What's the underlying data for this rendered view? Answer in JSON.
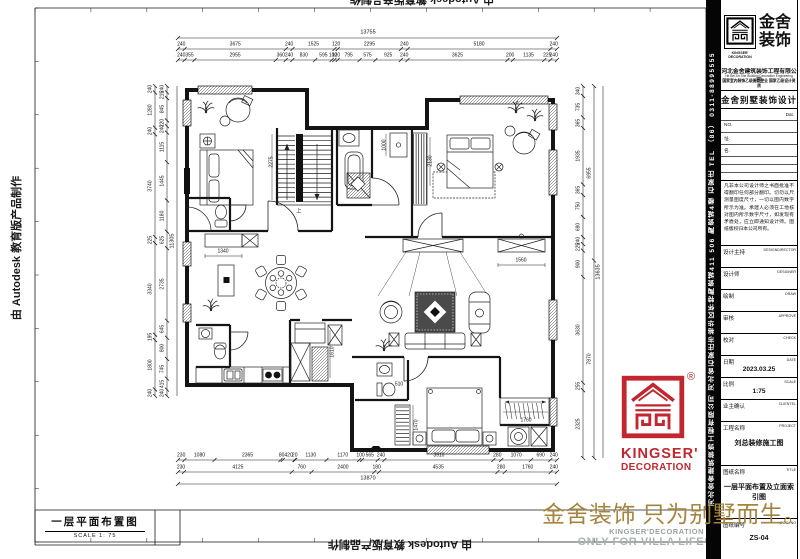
{
  "watermark": {
    "autodesk": "由 Autodesk 教育版产品制作"
  },
  "footer": {
    "slogan": "金舍装饰 只为别墅而生。",
    "brand_en": "KINGSER'DECORATION",
    "tagline": "ONLY FOR VILLA LIFE"
  },
  "drawing_label": {
    "title": "一层平面布置图",
    "scale": "SCALE 1: 75"
  },
  "stamp": {
    "line1": "KINGSER'",
    "line2": "DECORATION",
    "reg": "®"
  },
  "title_block": {
    "brand_cn_1": "金舍",
    "brand_cn_2": "装饰",
    "brand_en": "KINGSER'",
    "brand_en_sub": "DECORATION",
    "company": "河北金舍建筑装饰工程有限公司",
    "company_en": "He Bei Jin She Building Decoration Engineering Co.,Ltd",
    "qualification": "国家室内装饰乙级施工企业 国家乙级设计资质",
    "dept": "金舍别墅装饰设计",
    "date_hint": "Dat.",
    "no_label": "NO.",
    "addr_label": "址.",
    "name_label": "名.",
    "notice": "凡非本公司设计师之书面批准不得翻印任何部分翻印。切勿以尺测量图度尺寸，一切以图内数字所示为准。承建人必须在工地核对图内所示数字尺寸，如发现有矛盾处，应立即通知设计师。图纸版权归本公司所有。",
    "sidebar_text": "河北金舍建筑装饰工程有限公司  河北省石家庄市裕华区怀特陶瓷城411 506 陶瓷城4楼  石家庄  TEL （86） 0311-88995555",
    "fields": [
      {
        "label": "设计主持",
        "en": "DESIGNDIRECTOR",
        "value": ""
      },
      {
        "label": "设计师",
        "en": "DESIGNER",
        "value": ""
      },
      {
        "label": "绘制",
        "en": "DRAW",
        "value": ""
      },
      {
        "label": "审核",
        "en": "APPROVE",
        "value": ""
      },
      {
        "label": "校对",
        "en": "CHECK",
        "value": ""
      },
      {
        "label": "日期",
        "en": "DATE",
        "value": "2023.03.25"
      },
      {
        "label": "比例",
        "en": "SCALE",
        "value": "1:75"
      },
      {
        "label": "业主确认",
        "en": "CLIENTEL",
        "value": ""
      },
      {
        "label": "工程名称",
        "en": "PROJECT",
        "value": "刘总装修施工图"
      },
      {
        "label": "图纸名称",
        "en": "TITLE",
        "value": "一层平面布置及立面索引图"
      },
      {
        "label": "图纸编号",
        "en": "DWG. NO",
        "value": "ZS-04"
      }
    ]
  },
  "plan": {
    "top_total": "13755",
    "top_rows": [
      [
        "240",
        "3675",
        "240",
        "1525",
        "120",
        "2295",
        "240",
        "5180",
        "240"
      ],
      [
        "240",
        "355",
        "2955",
        "360",
        "240",
        "830",
        "595",
        "100",
        "120",
        "795",
        "575",
        "925",
        "240",
        "3625",
        "200",
        "1135",
        "225",
        "240"
      ]
    ],
    "bottom_rows": [
      [
        "230",
        "1080",
        "2365",
        "80",
        "420",
        "20",
        "1130",
        "1170",
        "100",
        "565",
        "240",
        "3910",
        "280",
        "1070",
        "690",
        "240"
      ],
      [
        "230",
        "4125",
        "760",
        "2400",
        "180",
        "4535",
        "280",
        "1760",
        "240"
      ]
    ],
    "bottom_total": "13870",
    "left_total": "11305",
    "left_cols": [
      [
        "240",
        "1280",
        "240",
        "3740",
        "225",
        "3340",
        "195",
        "1800",
        "240"
      ],
      [
        "240",
        "215",
        "845",
        "220",
        "240",
        "1115",
        "1445",
        "1180",
        "625",
        "2735",
        "645",
        "800",
        "745",
        "415",
        "240"
      ]
    ],
    "right_total": "13635",
    "right_cols": [
      [
        "340",
        "735",
        "365",
        "1935",
        "365",
        "750",
        "690",
        "240",
        "225",
        "900",
        "3630",
        "255",
        "2325"
      ],
      [
        "6955",
        "7870"
      ]
    ],
    "interior": [
      "2275",
      "1000",
      "2130",
      "1340",
      "1560",
      "1610",
      "510",
      "1470",
      "1760"
    ],
    "stairs_label": "上"
  }
}
